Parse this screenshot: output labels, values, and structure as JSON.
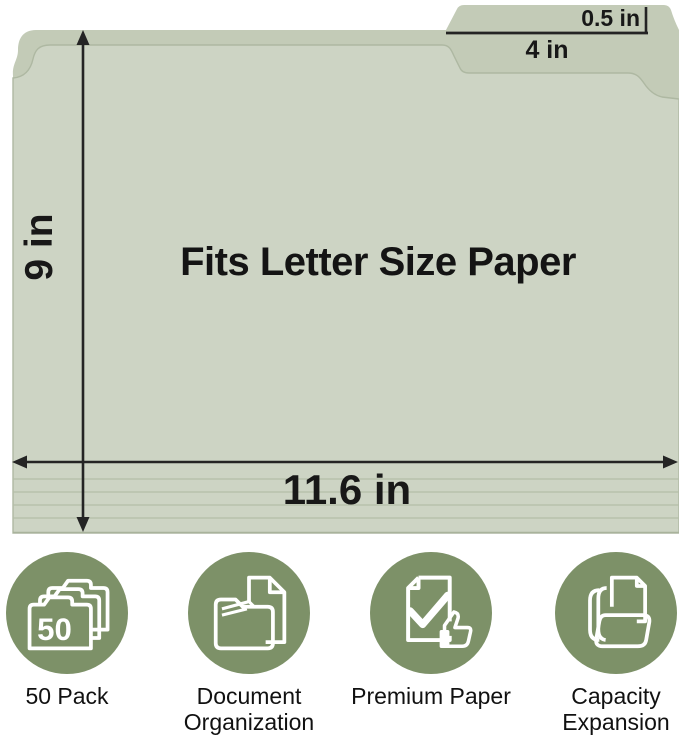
{
  "diagram": {
    "center_label": "Fits Letter Size Paper",
    "height_label": "9 in",
    "width_label": "11.6 in",
    "tab_height_label": "0.5 in",
    "tab_width_label": "4 in"
  },
  "features": [
    {
      "label": "50 Pack",
      "badge": "50",
      "icon": "folder-stack-icon"
    },
    {
      "label": "Document Organization",
      "icon": "document-folder-icon"
    },
    {
      "label": "Premium Paper",
      "icon": "checkmark-thumbs-up-icon"
    },
    {
      "label": "Capacity Expansion",
      "icon": "expanding-folder-icon"
    }
  ],
  "colors": {
    "background": "#ffffff",
    "folder_front": "#cdd4c4",
    "folder_back": "#c3cbb7",
    "emboss_line": "#aeb8a2",
    "dimension_ink": "#222222",
    "feature_circle_green": "#7d9168",
    "icon_stroke": "#ffffff",
    "label_ink": "#111111"
  }
}
